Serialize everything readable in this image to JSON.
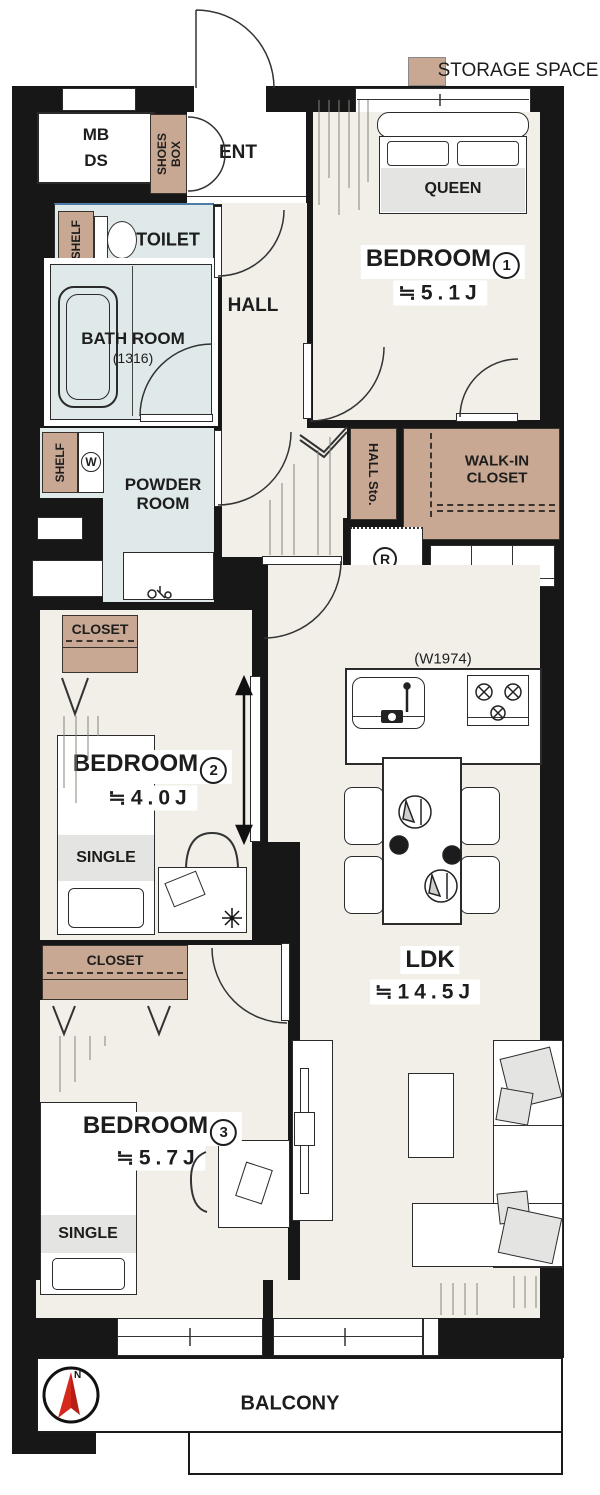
{
  "legend": {
    "label": "STORAGE SPACE",
    "swatch_color": "#c8a893"
  },
  "colors": {
    "wall": "#171717",
    "floor": "#f2efe9",
    "wet_area": "#dfe9ea",
    "storage": "#c8a893",
    "compass_red": "#d6281c"
  },
  "entry": {
    "mb": "MB",
    "ds": "DS",
    "shoes_line1": "SHOES",
    "shoes_line2": "BOX",
    "ent": "ENT"
  },
  "toilet": {
    "label": "TOILET",
    "shelf": "SHELF"
  },
  "bath": {
    "line1": "BATH ROOM",
    "line2": "(1316)"
  },
  "hall": {
    "label": "HALL",
    "storage": "HALL Sto."
  },
  "powder": {
    "line1": "POWDER",
    "line2": "ROOM",
    "shelf": "SHELF",
    "washer": "W"
  },
  "wic": {
    "line1": "WALK-IN",
    "line2": "CLOSET"
  },
  "kitchen": {
    "width_note": "(W1974)",
    "fridge": "R"
  },
  "bedroom1": {
    "name": "BEDROOM",
    "number": "1",
    "area": "≒5.1J",
    "bed": "QUEEN"
  },
  "bedroom2": {
    "name": "BEDROOM",
    "number": "2",
    "area": "≒4.0J",
    "bed": "SINGLE",
    "closet": "CLOSET"
  },
  "bedroom3": {
    "name": "BEDROOM",
    "number": "3",
    "area": "≒5.7J",
    "bed": "SINGLE",
    "closet": "CLOSET"
  },
  "ldk": {
    "name": "LDK",
    "area": "≒14.5J"
  },
  "balcony": {
    "label": "BALCONY",
    "north": "N"
  }
}
